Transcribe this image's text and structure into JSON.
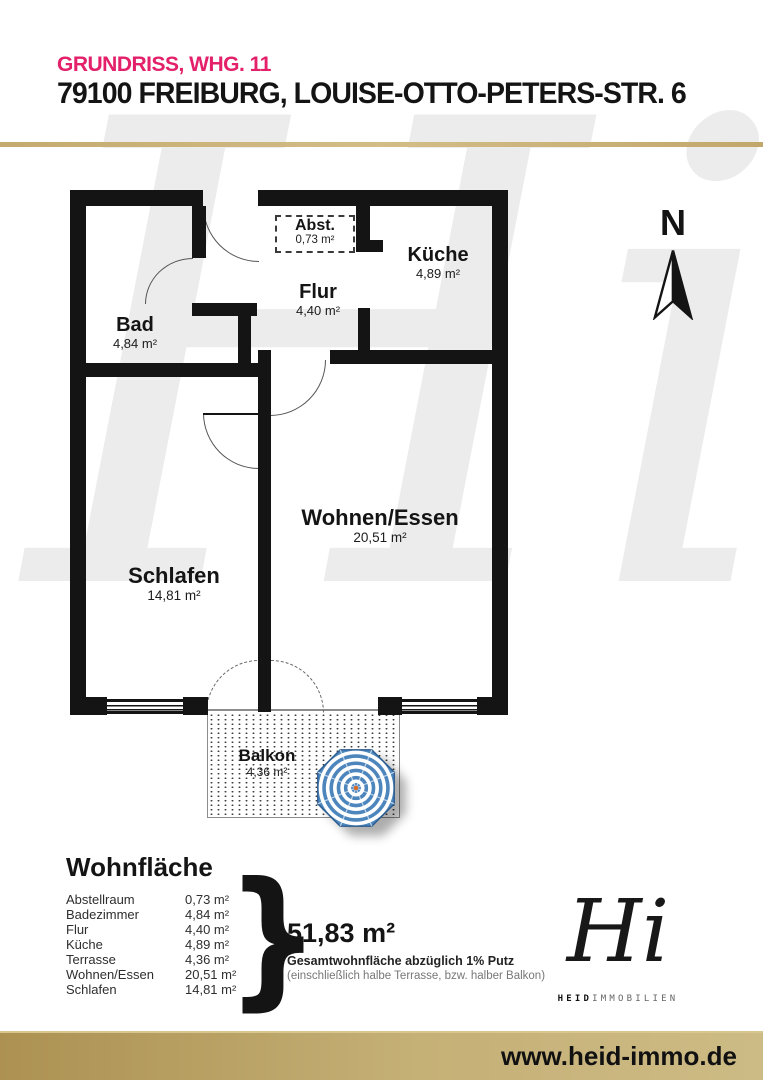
{
  "header": {
    "subtitle": "GRUNDRISS, WHG. 11",
    "title": "79100 FREIBURG, LOUISE-OTTO-PETERS-STR. 6"
  },
  "floorplan": {
    "north_label": "N",
    "rooms": [
      {
        "name": "Bad",
        "area": "4,84 m²"
      },
      {
        "name": "Flur",
        "area": "4,40 m²"
      },
      {
        "name": "Abst.",
        "area": "0,73 m²"
      },
      {
        "name": "Küche",
        "area": "4,89 m²"
      },
      {
        "name": "Schlafen",
        "area": "14,81 m²"
      },
      {
        "name": "Wohnen/Essen",
        "area": "20,51 m²"
      },
      {
        "name": "Balkon",
        "area": "4,36 m²"
      }
    ]
  },
  "area_summary": {
    "title": "Wohnfläche",
    "rows": [
      {
        "label": "Abstellraum",
        "value": "0,73 m²"
      },
      {
        "label": "Badezimmer",
        "value": "4,84 m²"
      },
      {
        "label": "Flur",
        "value": "4,40 m²"
      },
      {
        "label": "Küche",
        "value": "4,89 m²"
      },
      {
        "label": "Terrasse",
        "value": "4,36 m²"
      },
      {
        "label": "Wohnen/Essen",
        "value": "20,51 m²"
      },
      {
        "label": "Schlafen",
        "value": "14,81 m²"
      }
    ],
    "brace": "}",
    "total": "51,83 m²",
    "total_note_bold": "Gesamtwohnfläche abzüglich 1% Putz",
    "total_note": "(einschließlich halbe Terrasse, bzw. halber Balkon)"
  },
  "branding": {
    "watermark": "Hi",
    "logo_monogram": "Hi",
    "logo_name_bold": "HEID",
    "logo_name_light": "IMMOBILIEN"
  },
  "footer": {
    "website": "www.heid-immo.de"
  },
  "colors": {
    "accent_pink": "#e32069",
    "gold": "#c3a96f",
    "wall_black": "#141414",
    "umbrella_blue": "#4d85bd"
  }
}
